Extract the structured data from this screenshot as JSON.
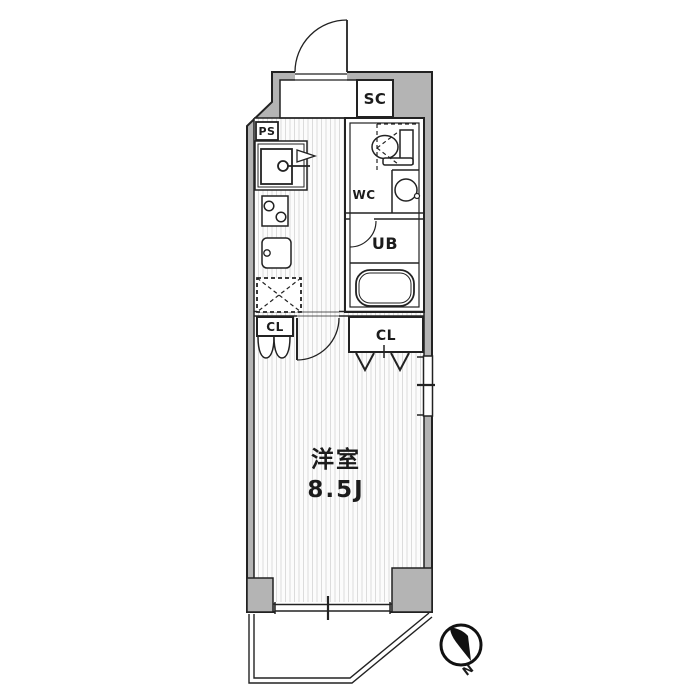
{
  "colors": {
    "wall": "#b4b4b4",
    "line": "#222222",
    "stripe": "#dcdcdc",
    "floor": "#fcfcfc",
    "needle": "#111111"
  },
  "labels": {
    "shoe_closet": "SC",
    "pipe_space": "PS",
    "toilet_room": "WC",
    "unit_bath": "UB",
    "closet_left": "CL",
    "closet_right": "CL",
    "room_name": "洋室",
    "room_size": "8.5J",
    "compass_north": "N"
  }
}
